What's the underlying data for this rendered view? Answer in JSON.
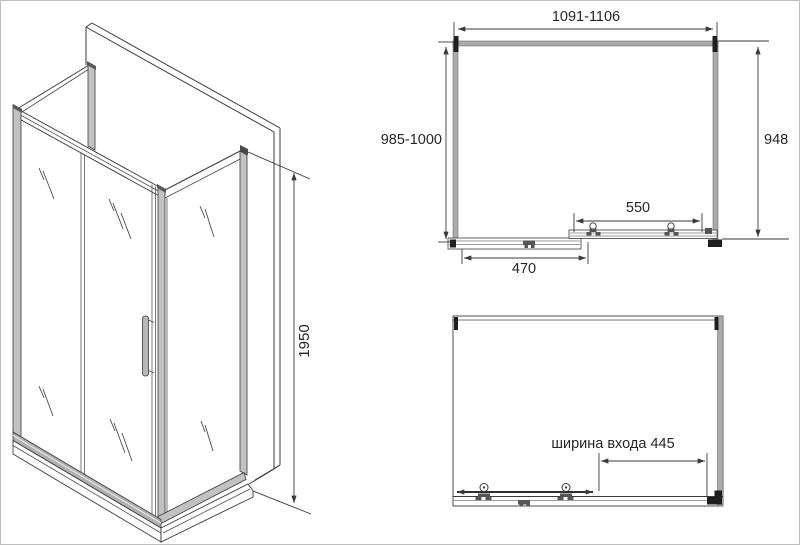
{
  "colors": {
    "line": "#3a3a3a",
    "profile_fill": "#b5b5b5",
    "bracket": "#1f1f1f",
    "background": "#ffffff",
    "border": "#bdbdbd"
  },
  "isometric_view": {
    "height_dim": "1950"
  },
  "plan_view": {
    "width_dim": "1091-1106",
    "depth_dim": "985-1000",
    "side_dim": "948",
    "door_dim": "550",
    "fixed_panel_dim": "470"
  },
  "front_view": {
    "entry_dim": "ширина входа 445"
  }
}
